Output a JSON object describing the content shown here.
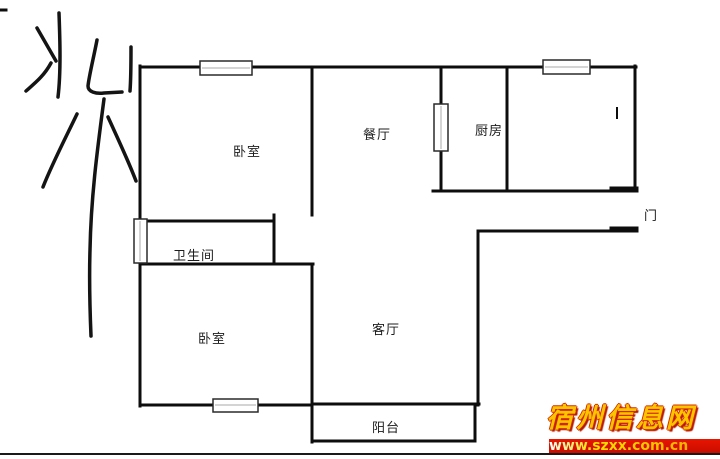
{
  "compass": {
    "label": "北"
  },
  "rooms": {
    "bedroom_top": "卧室",
    "dining": "餐厅",
    "kitchen": "厨房",
    "bathroom": "卫生间",
    "bedroom_bottom": "卧室",
    "living_room": "客厅",
    "balcony": "阳台",
    "door": "门"
  },
  "watermark": {
    "site_name": "宿州信息网",
    "url": "www.szxx.com.cn",
    "bar_color": "#d81000",
    "site_text_color": "#ffc400",
    "outline_color": "#d42a00"
  },
  "style_colors": {
    "wall": "#0d0d0d",
    "background": "#ffffff",
    "label_text": "#1c1c1c"
  }
}
